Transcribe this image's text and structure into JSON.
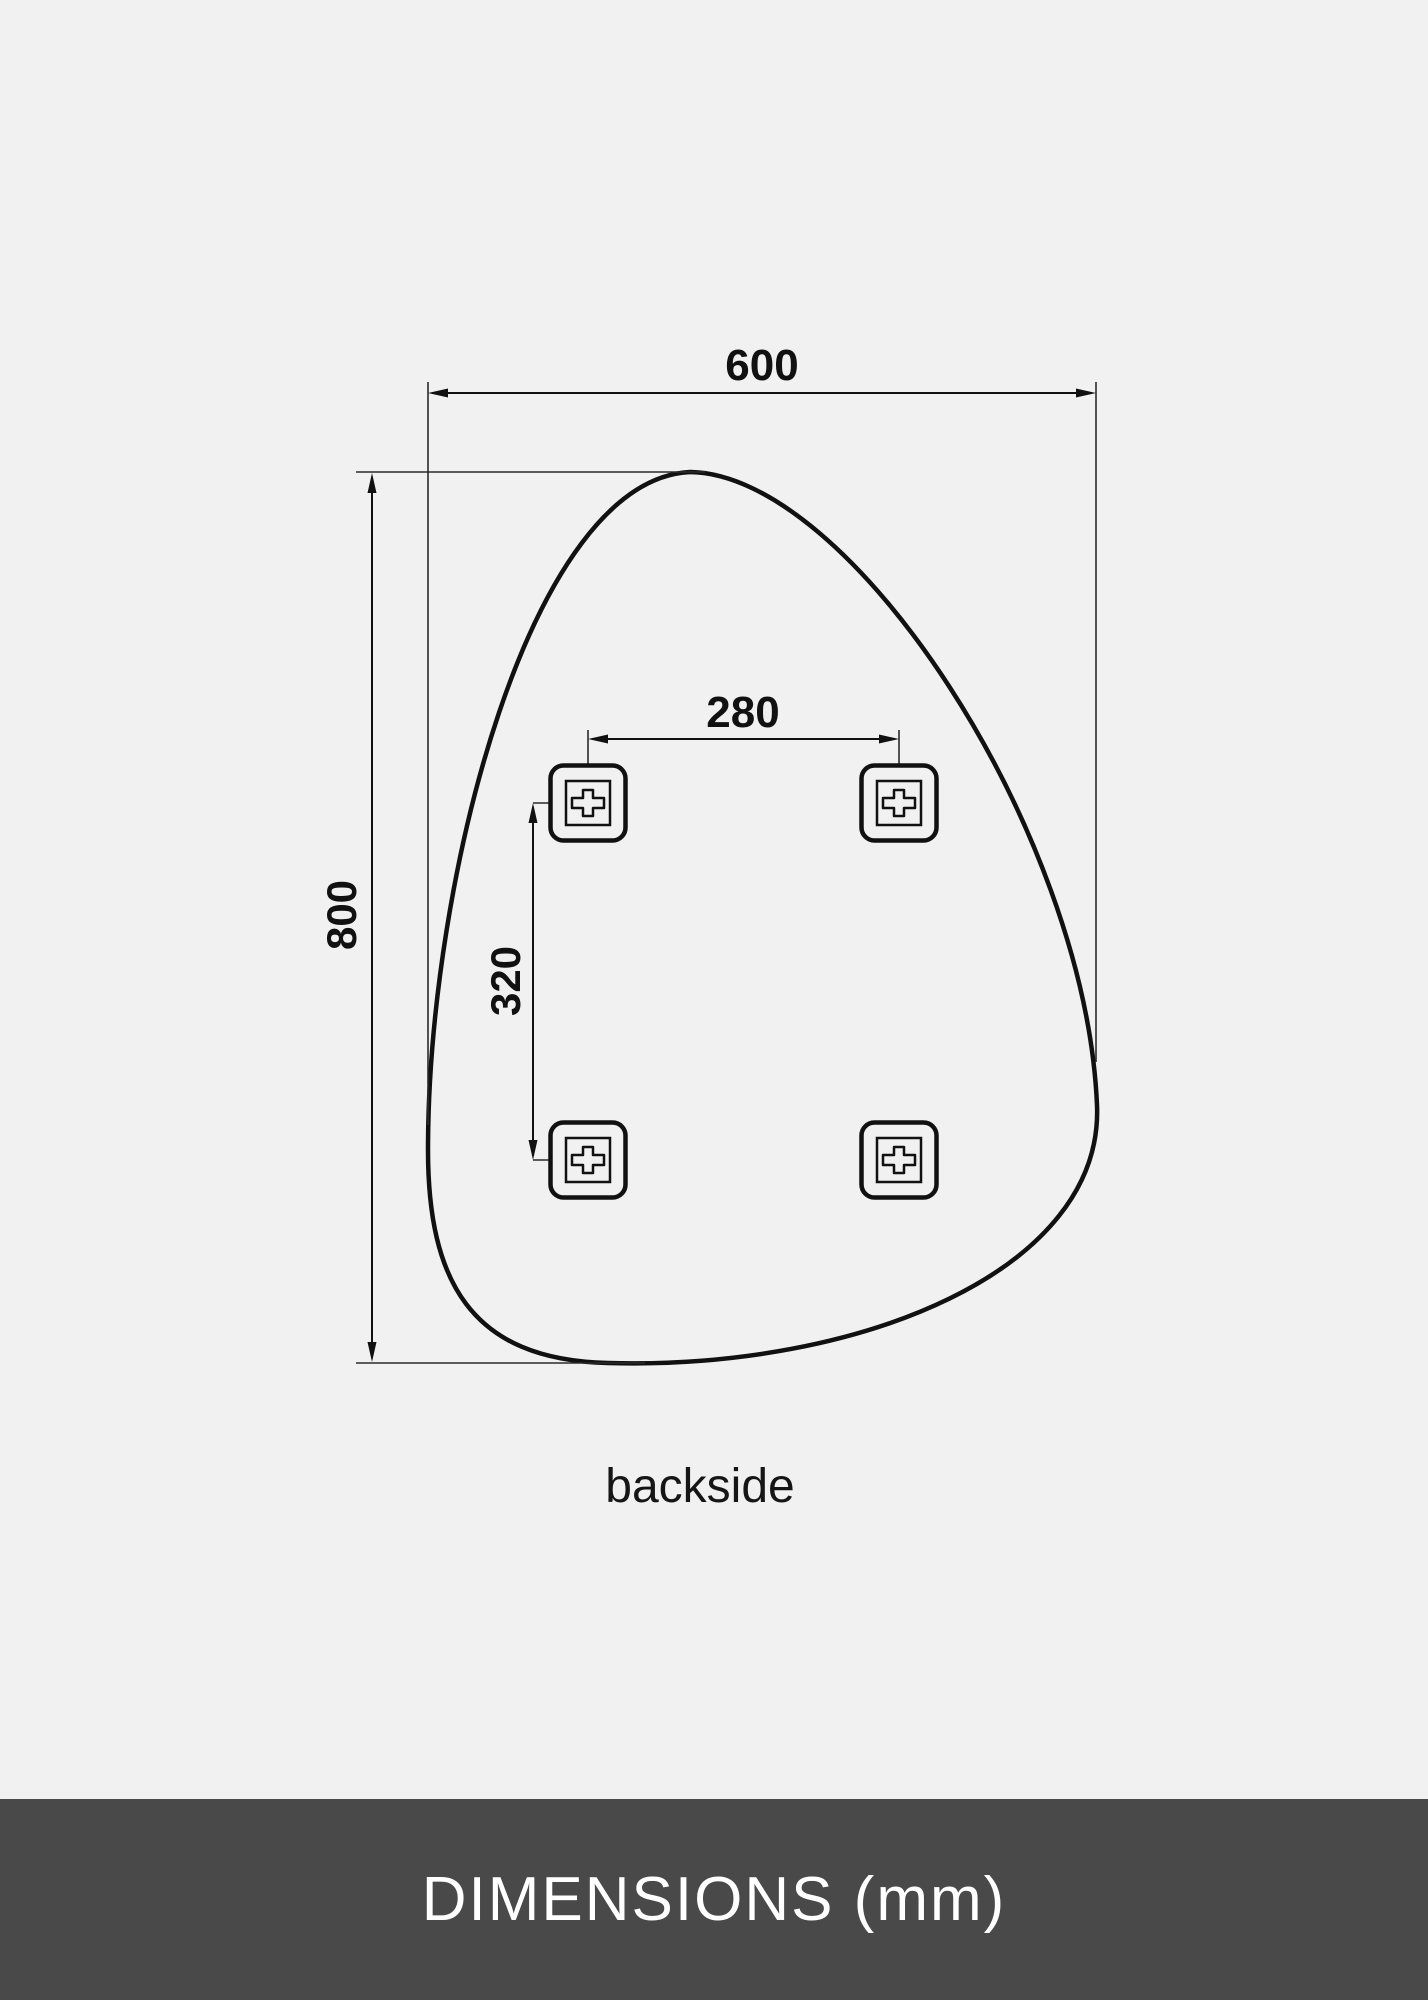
{
  "page": {
    "background_color": "#f1f1f1",
    "line_color": "#111111"
  },
  "drawing": {
    "view_label": "backside",
    "width_dim": {
      "value": "600"
    },
    "height_dim": {
      "value": "800"
    },
    "hole_spacing_horizontal": {
      "value": "280"
    },
    "hole_spacing_vertical": {
      "value": "320"
    },
    "mounting_brackets": {
      "count": 4,
      "icon": "plus-in-square-icon"
    }
  },
  "footer": {
    "title": "DIMENSIONS (mm)",
    "background_color": "#494949",
    "text_color": "#ffffff"
  }
}
